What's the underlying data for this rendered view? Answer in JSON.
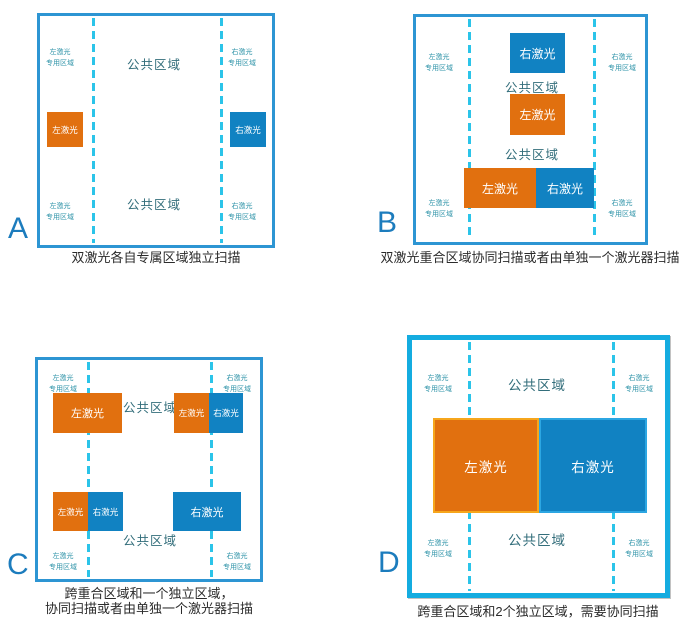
{
  "labels": {
    "left_laser": "左激光",
    "right_laser": "右激光",
    "common_area": "公共区域",
    "zone_line2": "专用区域"
  },
  "panels": [
    {
      "letter": "A",
      "caption": "双激光各自专属区域独立扫描"
    },
    {
      "letter": "B",
      "caption": "双激光重合区域协同扫描或者由单独一个激光器扫描"
    },
    {
      "letter": "C",
      "caption": "跨重合区域和一个独立区域，\n协同扫描或者由单独一个激光器扫描"
    },
    {
      "letter": "D",
      "caption": "跨重合区域和2个独立区域，需要协同扫描"
    }
  ],
  "colors": {
    "panel_border": "#2d95d3",
    "panel_border_d": "#14ace0",
    "dashed_line": "#2bc4e9",
    "left_laser_fill": "#e1700f",
    "left_laser_edge": "#f6a61c",
    "right_laser_fill": "#1182c2",
    "right_laser_edge": "#2ca6e2",
    "common_label": "#336e7b",
    "corner_label": "#2e93a8",
    "panel_letter": "#1c7cbd",
    "caption": "#2b2b2b"
  }
}
